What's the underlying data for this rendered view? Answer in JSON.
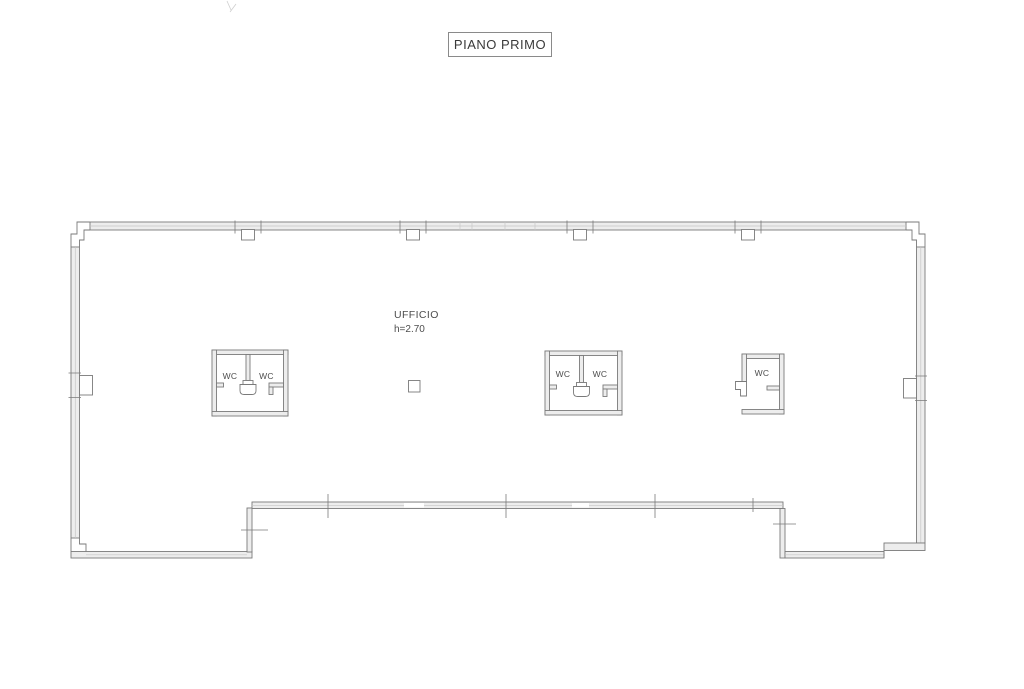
{
  "title_block": {
    "label": "PIANO PRIMO"
  },
  "office": {
    "name": "UFFICIO",
    "height_label": "h=2.70"
  },
  "wc_blocks": {
    "left": {
      "room1_label": "WC",
      "room2_label": "WC"
    },
    "middle": {
      "room1_label": "WC",
      "room2_label": "WC"
    },
    "right": {
      "room_label": "WC"
    }
  },
  "colors": {
    "background": "#ffffff",
    "line": "#7a7a7a",
    "line_light": "#c6c6c6",
    "wall_fill": "#ededed",
    "text": "#4d4d4d"
  }
}
